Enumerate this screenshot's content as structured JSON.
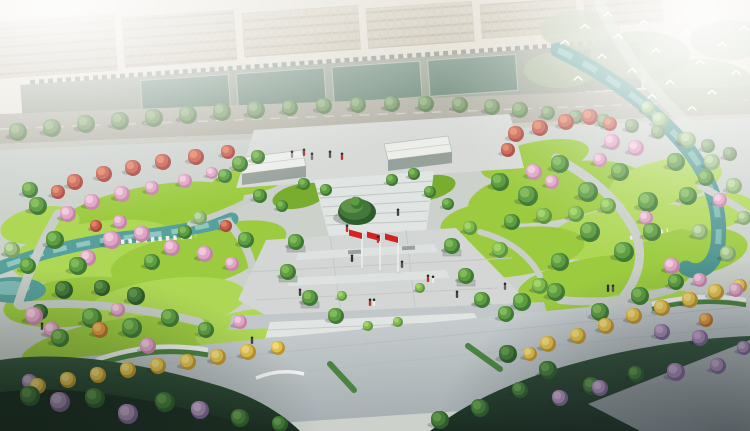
{
  "scene": {
    "setting": "aerial-park-master-plan-rendering",
    "palette": {
      "haze": "#eef0ea",
      "building": "#c6bda9",
      "road": "#b2b0a4",
      "court": "#6c8878",
      "park_paving": "#ccd1cc",
      "plaza": "#d3d6d4",
      "steps": "#e0e4e2",
      "south_plaza_top": "#d4d9da",
      "south_plaza_bottom": "#a6aeb1",
      "lawn": "#9ccb40",
      "lawn_light": "#aed755",
      "lawn_dark": "#79ad30",
      "water": "#58a09b",
      "water_right": "#4f958f",
      "path": "#c9cec9",
      "flag_red": "#d42420",
      "dark_mass": "#1b2d22",
      "bird_white": "#ffffff"
    },
    "flags": {
      "count": 3,
      "color": "#d42420",
      "pole_color": "#f2f2f2",
      "poles_x": [
        362,
        380,
        398
      ],
      "top_y": 233,
      "base_y": 268
    },
    "tree_types": {
      "g": {
        "name": "tree-green",
        "colors": [
          "#3f7a34",
          "#5d9c42",
          "#7fba58"
        ]
      },
      "lg": {
        "name": "tree-light-green",
        "colors": [
          "#5d9440",
          "#7fb951",
          "#a2d468"
        ]
      },
      "dg": {
        "name": "tree-dark-green",
        "colors": [
          "#2e5c2c",
          "#44783a",
          "#5e9449"
        ]
      },
      "p": {
        "name": "tree-pink-blossom",
        "colors": [
          "#c585a8",
          "#e0a5c6",
          "#f0c8dc"
        ]
      },
      "pm": {
        "name": "tree-purple-blossom",
        "colors": [
          "#7d6390",
          "#a98bb4",
          "#c4a9cd"
        ]
      },
      "r": {
        "name": "tree-red-flowering",
        "colors": [
          "#a8453c",
          "#c85f4e",
          "#e28262"
        ]
      },
      "y": {
        "name": "tree-ginkgo-yellow",
        "colors": [
          "#bc942f",
          "#e2c14e",
          "#f2da7a"
        ]
      },
      "o": {
        "name": "tree-orange",
        "colors": [
          "#b47127",
          "#dd9742",
          "#efb95f"
        ]
      },
      "w": {
        "name": "tree-willow",
        "colors": [
          "#7fa368",
          "#9cbf82",
          "#bdd8a2"
        ]
      },
      "st": {
        "name": "tree-street",
        "colors": [
          "#67875a",
          "#7d9d6c",
          "#97b384"
        ]
      }
    },
    "trees": [
      [
        18,
        132,
        9,
        "st"
      ],
      [
        52,
        128,
        9,
        "st"
      ],
      [
        86,
        124,
        9,
        "st"
      ],
      [
        120,
        121,
        9,
        "st"
      ],
      [
        154,
        118,
        9,
        "st"
      ],
      [
        188,
        115,
        9,
        "st"
      ],
      [
        222,
        112,
        9,
        "st"
      ],
      [
        256,
        110,
        9,
        "st"
      ],
      [
        290,
        108,
        8,
        "st"
      ],
      [
        324,
        106,
        8,
        "st"
      ],
      [
        358,
        105,
        8,
        "st"
      ],
      [
        392,
        104,
        8,
        "st"
      ],
      [
        426,
        104,
        8,
        "st"
      ],
      [
        460,
        105,
        8,
        "st"
      ],
      [
        492,
        107,
        8,
        "st"
      ],
      [
        520,
        110,
        8,
        "st"
      ],
      [
        548,
        113,
        7,
        "st"
      ],
      [
        576,
        117,
        7,
        "st"
      ],
      [
        604,
        121,
        7,
        "st"
      ],
      [
        632,
        126,
        7,
        "st"
      ],
      [
        658,
        132,
        7,
        "st"
      ],
      [
        684,
        139,
        7,
        "st"
      ],
      [
        708,
        146,
        7,
        "st"
      ],
      [
        730,
        154,
        7,
        "st"
      ],
      [
        75,
        182,
        8,
        "r"
      ],
      [
        104,
        174,
        8,
        "r"
      ],
      [
        133,
        168,
        8,
        "r"
      ],
      [
        163,
        162,
        8,
        "r"
      ],
      [
        196,
        157,
        8,
        "r"
      ],
      [
        228,
        152,
        7,
        "r"
      ],
      [
        58,
        192,
        7,
        "r"
      ],
      [
        92,
        202,
        8,
        "p"
      ],
      [
        122,
        194,
        8,
        "p"
      ],
      [
        152,
        188,
        7,
        "p"
      ],
      [
        185,
        181,
        7,
        "p"
      ],
      [
        68,
        214,
        8,
        "p"
      ],
      [
        212,
        173,
        6,
        "p"
      ],
      [
        38,
        206,
        9,
        "g"
      ],
      [
        240,
        164,
        8,
        "g"
      ],
      [
        258,
        157,
        7,
        "g"
      ],
      [
        30,
        190,
        8,
        "g"
      ],
      [
        225,
        176,
        7,
        "g"
      ],
      [
        112,
        240,
        9,
        "p"
      ],
      [
        142,
        234,
        8,
        "p"
      ],
      [
        172,
        248,
        8,
        "p"
      ],
      [
        205,
        254,
        8,
        "p"
      ],
      [
        88,
        258,
        8,
        "p"
      ],
      [
        232,
        264,
        7,
        "p"
      ],
      [
        120,
        222,
        7,
        "p"
      ],
      [
        55,
        240,
        9,
        "g"
      ],
      [
        78,
        266,
        9,
        "g"
      ],
      [
        152,
        262,
        8,
        "g"
      ],
      [
        246,
        240,
        8,
        "g"
      ],
      [
        28,
        266,
        8,
        "g"
      ],
      [
        185,
        232,
        7,
        "g"
      ],
      [
        64,
        290,
        9,
        "dg"
      ],
      [
        136,
        296,
        9,
        "dg"
      ],
      [
        40,
        312,
        8,
        "dg"
      ],
      [
        102,
        288,
        8,
        "dg"
      ],
      [
        96,
        226,
        6,
        "r"
      ],
      [
        226,
        226,
        6,
        "r"
      ],
      [
        12,
        250,
        8,
        "w"
      ],
      [
        200,
        218,
        7,
        "w"
      ],
      [
        92,
        318,
        10,
        "g"
      ],
      [
        132,
        328,
        10,
        "g"
      ],
      [
        170,
        318,
        9,
        "g"
      ],
      [
        60,
        338,
        9,
        "g"
      ],
      [
        206,
        330,
        8,
        "g"
      ],
      [
        34,
        316,
        9,
        "p"
      ],
      [
        52,
        330,
        8,
        "p"
      ],
      [
        148,
        346,
        8,
        "p"
      ],
      [
        240,
        322,
        7,
        "p"
      ],
      [
        118,
        310,
        7,
        "p"
      ],
      [
        100,
        330,
        8,
        "o"
      ],
      [
        38,
        386,
        8,
        "y"
      ],
      [
        68,
        380,
        8,
        "y"
      ],
      [
        98,
        375,
        8,
        "y"
      ],
      [
        128,
        370,
        8,
        "y"
      ],
      [
        158,
        366,
        8,
        "y"
      ],
      [
        188,
        362,
        8,
        "y"
      ],
      [
        218,
        357,
        8,
        "y"
      ],
      [
        248,
        352,
        8,
        "y"
      ],
      [
        278,
        348,
        7,
        "y"
      ],
      [
        296,
        242,
        8,
        "g"
      ],
      [
        288,
        272,
        8,
        "g"
      ],
      [
        310,
        298,
        8,
        "g"
      ],
      [
        336,
        316,
        8,
        "g"
      ],
      [
        452,
        246,
        8,
        "g"
      ],
      [
        466,
        276,
        8,
        "g"
      ],
      [
        482,
        300,
        8,
        "g"
      ],
      [
        506,
        314,
        8,
        "g"
      ],
      [
        304,
        184,
        6,
        "g"
      ],
      [
        326,
        190,
        6,
        "g"
      ],
      [
        392,
        180,
        6,
        "g"
      ],
      [
        414,
        174,
        6,
        "g"
      ],
      [
        260,
        196,
        7,
        "g"
      ],
      [
        282,
        206,
        6,
        "g"
      ],
      [
        430,
        192,
        6,
        "g"
      ],
      [
        448,
        204,
        6,
        "g"
      ],
      [
        342,
        296,
        5,
        "lg"
      ],
      [
        420,
        288,
        5,
        "lg"
      ],
      [
        368,
        326,
        5,
        "lg"
      ],
      [
        398,
        322,
        5,
        "lg"
      ],
      [
        516,
        134,
        8,
        "r"
      ],
      [
        540,
        128,
        8,
        "r"
      ],
      [
        566,
        122,
        8,
        "r"
      ],
      [
        590,
        117,
        8,
        "r"
      ],
      [
        610,
        124,
        7,
        "r"
      ],
      [
        508,
        150,
        7,
        "r"
      ],
      [
        612,
        142,
        8,
        "p"
      ],
      [
        636,
        148,
        8,
        "p"
      ],
      [
        534,
        172,
        8,
        "p"
      ],
      [
        552,
        182,
        7,
        "p"
      ],
      [
        600,
        160,
        7,
        "p"
      ],
      [
        646,
        218,
        7,
        "p"
      ],
      [
        672,
        266,
        8,
        "p"
      ],
      [
        700,
        280,
        7,
        "p"
      ],
      [
        720,
        200,
        7,
        "p"
      ],
      [
        736,
        290,
        7,
        "p"
      ],
      [
        500,
        182,
        9,
        "g"
      ],
      [
        528,
        196,
        10,
        "g"
      ],
      [
        560,
        164,
        9,
        "g"
      ],
      [
        588,
        192,
        10,
        "g"
      ],
      [
        620,
        172,
        9,
        "g"
      ],
      [
        648,
        202,
        10,
        "g"
      ],
      [
        676,
        162,
        9,
        "g"
      ],
      [
        590,
        232,
        10,
        "g"
      ],
      [
        624,
        252,
        10,
        "g"
      ],
      [
        560,
        262,
        9,
        "g"
      ],
      [
        512,
        222,
        8,
        "g"
      ],
      [
        652,
        232,
        9,
        "g"
      ],
      [
        688,
        196,
        9,
        "g"
      ],
      [
        706,
        178,
        8,
        "g"
      ],
      [
        660,
        120,
        8,
        "w"
      ],
      [
        688,
        140,
        8,
        "w"
      ],
      [
        712,
        162,
        8,
        "w"
      ],
      [
        734,
        186,
        8,
        "w"
      ],
      [
        700,
        232,
        8,
        "w"
      ],
      [
        728,
        254,
        8,
        "w"
      ],
      [
        744,
        218,
        7,
        "w"
      ],
      [
        648,
        108,
        7,
        "w"
      ],
      [
        544,
        216,
        8,
        "lg"
      ],
      [
        576,
        214,
        8,
        "lg"
      ],
      [
        608,
        206,
        8,
        "lg"
      ],
      [
        500,
        250,
        8,
        "lg"
      ],
      [
        540,
        286,
        8,
        "lg"
      ],
      [
        470,
        228,
        7,
        "lg"
      ],
      [
        522,
        302,
        9,
        "g"
      ],
      [
        556,
        292,
        9,
        "g"
      ],
      [
        600,
        312,
        9,
        "g"
      ],
      [
        640,
        296,
        9,
        "g"
      ],
      [
        676,
        282,
        8,
        "g"
      ],
      [
        548,
        344,
        8,
        "y"
      ],
      [
        578,
        336,
        8,
        "y"
      ],
      [
        606,
        326,
        8,
        "y"
      ],
      [
        634,
        316,
        8,
        "y"
      ],
      [
        662,
        308,
        8,
        "y"
      ],
      [
        690,
        300,
        8,
        "y"
      ],
      [
        716,
        292,
        8,
        "y"
      ],
      [
        740,
        286,
        7,
        "y"
      ],
      [
        530,
        354,
        7,
        "y"
      ],
      [
        706,
        320,
        7,
        "o"
      ],
      [
        60,
        402,
        10,
        "pm"
      ],
      [
        128,
        414,
        10,
        "pm"
      ],
      [
        200,
        410,
        9,
        "pm"
      ],
      [
        30,
        382,
        8,
        "pm"
      ],
      [
        662,
        332,
        8,
        "pm"
      ],
      [
        700,
        338,
        8,
        "pm"
      ],
      [
        676,
        372,
        9,
        "pm"
      ],
      [
        718,
        366,
        8,
        "pm"
      ],
      [
        744,
        348,
        7,
        "pm"
      ],
      [
        600,
        388,
        8,
        "pm"
      ],
      [
        560,
        398,
        8,
        "pm"
      ],
      [
        30,
        396,
        10,
        "dg"
      ],
      [
        95,
        398,
        10,
        "dg"
      ],
      [
        165,
        402,
        10,
        "dg"
      ],
      [
        240,
        418,
        9,
        "dg"
      ],
      [
        280,
        424,
        8,
        "dg"
      ],
      [
        508,
        354,
        9,
        "dg"
      ],
      [
        548,
        370,
        9,
        "dg"
      ],
      [
        592,
        386,
        9,
        "dg"
      ],
      [
        636,
        374,
        8,
        "dg"
      ],
      [
        520,
        390,
        8,
        "dg"
      ],
      [
        480,
        408,
        9,
        "dg"
      ],
      [
        440,
        420,
        9,
        "dg"
      ]
    ],
    "people": [
      [
        347,
        232,
        "#c03030"
      ],
      [
        352,
        262,
        "#333333"
      ],
      [
        402,
        268,
        "#555555"
      ],
      [
        428,
        282,
        "#c03030"
      ],
      [
        433,
        283,
        "#ededed"
      ],
      [
        370,
        306,
        "#c03030"
      ],
      [
        374,
        306,
        "#ededed"
      ],
      [
        300,
        296,
        "#444444"
      ],
      [
        457,
        298,
        "#444444"
      ],
      [
        505,
        290,
        "#666666"
      ],
      [
        608,
        292,
        "#333333"
      ],
      [
        613,
        292,
        "#555555"
      ],
      [
        42,
        330,
        "#444444"
      ],
      [
        252,
        344,
        "#444444"
      ],
      [
        312,
        160,
        "#777777"
      ],
      [
        330,
        158,
        "#555555"
      ],
      [
        342,
        160,
        "#c03030"
      ],
      [
        292,
        158,
        "#999999"
      ],
      [
        304,
        156,
        "#aa3333"
      ],
      [
        398,
        216,
        "#444444"
      ],
      [
        378,
        243,
        "#c03030"
      ]
    ],
    "birds": [
      [
        565,
        42
      ],
      [
        585,
        26
      ],
      [
        602,
        56
      ],
      [
        618,
        36
      ],
      [
        632,
        70
      ],
      [
        644,
        22
      ],
      [
        656,
        50
      ],
      [
        670,
        82
      ],
      [
        686,
        32
      ],
      [
        700,
        62
      ],
      [
        712,
        92
      ],
      [
        722,
        44
      ],
      [
        736,
        72
      ],
      [
        744,
        28
      ],
      [
        652,
        96
      ],
      [
        692,
        108
      ],
      [
        608,
        14
      ],
      [
        578,
        78
      ]
    ]
  }
}
